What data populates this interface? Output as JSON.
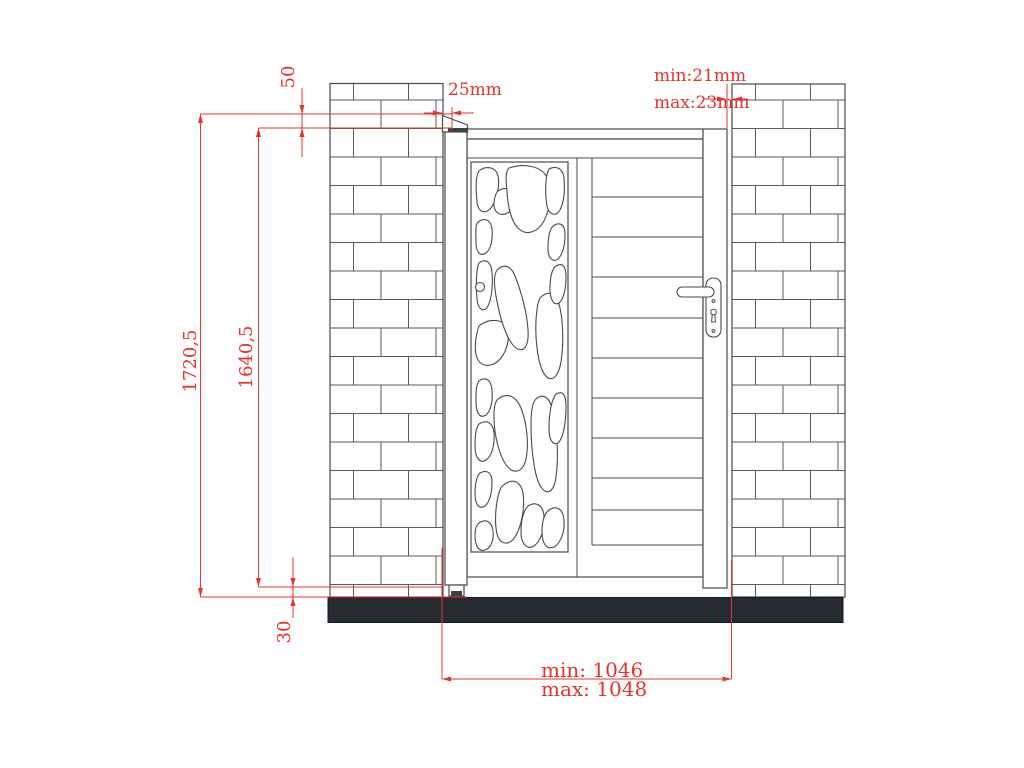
{
  "labels": {
    "cap_height": "50",
    "cap_overhang": "25mm",
    "top_gap_min": "min:21mm",
    "top_gap_max": "max:23mm",
    "total_height": "1720,5",
    "gate_height": "1640,5",
    "ground_clearance": "30",
    "opening_min": "min: 1046",
    "opening_max": "max: 1048"
  },
  "colors": {
    "dimension_red": "#e8332c",
    "line_gray": "#4a4a4a",
    "base_black": "#262a31"
  }
}
